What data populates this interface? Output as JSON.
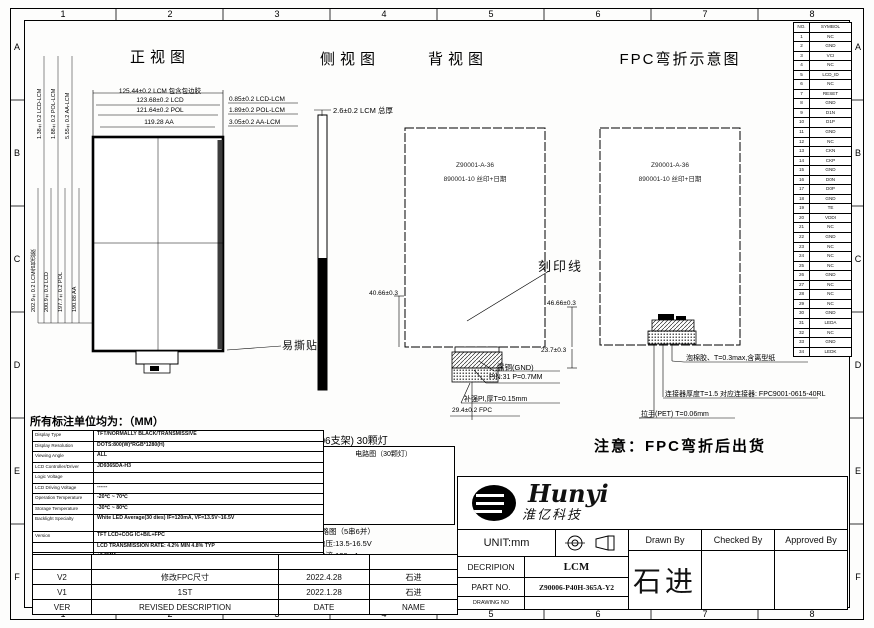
{
  "sheet": {
    "columns": [
      "1",
      "2",
      "3",
      "4",
      "5",
      "6",
      "7",
      "8"
    ],
    "rows": [
      "A",
      "B",
      "C",
      "D",
      "E",
      "F"
    ]
  },
  "views": {
    "front": {
      "title": "正视图",
      "h_dims": [
        "125.44±0.2 LCM 包含包边胶",
        "123.68±0.2 LCD",
        "121.64±0.2 POL",
        "119.28 AA"
      ],
      "h_side_dims": [
        "0.85±0.2 LCD-LCM",
        "1.89±0.2 POL-LCM",
        "3.05±0.2 AA-LCM"
      ],
      "v_dims_top": [
        "1.38±0.2 LCD-LCM",
        "1.88±0.2 POL-LCM",
        "5.55±0.2 AA-LCM"
      ],
      "v_dims": [
        "202.9±0.2 LCM含包边胶",
        "200.9±0.2 LCD",
        "197.7±0.2 POL",
        "190.88 AA"
      ],
      "tear_label": "易撕贴"
    },
    "side": {
      "title": "侧视图",
      "thickness_dim": "2.6±0.2 LCM 总厚"
    },
    "back": {
      "title": "背视图",
      "center_line1": "Z90001-A-36",
      "center_line2": "890001-10 丝印+日期",
      "engrave_callout": "刻印线",
      "dim_left": "40.66±0.3",
      "dim_right": "46.66±0.3",
      "dim_right2": "23.7±0.3",
      "label_gnd": "露铜(GND)",
      "label_pin": "PIN:31 P=0.7MM",
      "label_stiffener": "补强PI,厚T=0.15mm",
      "label_fpc_width": "29.4±0.2 FPC"
    },
    "fpc": {
      "title": "FPC弯折示意图",
      "center_line1": "Z90001-A-36",
      "center_line2": "890001-10 丝印+日期",
      "callout_foam": "泡棉胶、T=0.3max,含离型纸",
      "callout_connector": "连接器厚度T=1.5 对应连接器: FPC9001-0615-40RL",
      "callout_handle": "拉手(PET) T=0.06mm"
    }
  },
  "notes": {
    "units": "所有标注单位均为：（MM）",
    "ship": "注意：FPC弯折后出货"
  },
  "circuit": {
    "heading": "(3006支架) 30颗灯",
    "box_label": "电路图（30颗灯）",
    "sub1": "电路图（5串6并）",
    "sub2": "电压:13.5-16.5V",
    "sub3": "电流:120mA"
  },
  "spec_table": {
    "rows": [
      {
        "label": "Display Type",
        "value": "TFT/NORMALLY BLACK/TRANSMISSIVE"
      },
      {
        "label": "Display Resolution",
        "value": "DOTS:800(W)*RGB*1280(H)"
      },
      {
        "label": "Viewing Angle",
        "value": "ALL"
      },
      {
        "label": "LCD Controller/Driver",
        "value": "JD9365DA-H3"
      },
      {
        "label": "Logic Voltage",
        "value": ""
      },
      {
        "label": "LCD Driving Voltage",
        "value": "------"
      },
      {
        "label": "Operation Temperature",
        "value": "-20℃ ~ 70℃"
      },
      {
        "label": "Storage Temperature",
        "value": "-30℃ ~ 80℃"
      },
      {
        "label": "Backlight Specialty",
        "value": "White LED Average(30 dies) IF=120mA, VF=13.5V~16.5V"
      },
      {
        "label": "Version",
        "value": "TFT LCD+COG IC+B/L+FPC"
      },
      {
        "label": "",
        "value": "LCD TRANSMISSION RATE: 4.2% MIN 4.8% TYP"
      },
      {
        "label": "Unmarked tolerances",
        "value": "±0.2MM"
      },
      {
        "label": "",
        "value": "*:Critical dimension"
      }
    ]
  },
  "revision_table": {
    "headers": {
      "ver": "VER",
      "desc": "REVISED DESCRIPTION",
      "date": "DATE",
      "name": "NAME"
    },
    "rows": [
      {
        "ver": "V2",
        "desc": "修改FPC尺寸",
        "date": "2022.4.28",
        "name": "石进"
      },
      {
        "ver": "V1",
        "desc": "1ST",
        "date": "2022.1.28",
        "name": "石进"
      }
    ]
  },
  "title_block": {
    "logo_text": "Hunyi",
    "logo_sub": "淮亿科技",
    "unit": "UNIT:mm",
    "desc_label": "DECRIPION",
    "desc_value": "LCM",
    "part_label": "PART NO.",
    "part_value": "Z90006-P40H-365A-Y2",
    "drawing_label": "DRAWING NO",
    "drawn_by": "Drawn By",
    "checked_by": "Checked By",
    "approved_by": "Approved By",
    "drawn_name": "石进",
    "checked_name": "",
    "approved_name": ""
  },
  "pin_table": {
    "headers": {
      "no": "NO.",
      "sym": "SYMBOL"
    },
    "rows": [
      {
        "no": "1",
        "sym": "NC"
      },
      {
        "no": "2",
        "sym": "GND"
      },
      {
        "no": "3",
        "sym": "VCI"
      },
      {
        "no": "4",
        "sym": "NC"
      },
      {
        "no": "5",
        "sym": "LCD_ID"
      },
      {
        "no": "6",
        "sym": "NC"
      },
      {
        "no": "7",
        "sym": "RESET"
      },
      {
        "no": "8",
        "sym": "GND"
      },
      {
        "no": "9",
        "sym": "D1N"
      },
      {
        "no": "10",
        "sym": "D1P"
      },
      {
        "no": "11",
        "sym": "GND"
      },
      {
        "no": "12",
        "sym": "NC"
      },
      {
        "no": "13",
        "sym": "CKN"
      },
      {
        "no": "14",
        "sym": "CKP"
      },
      {
        "no": "15",
        "sym": "GND"
      },
      {
        "no": "16",
        "sym": "D0N"
      },
      {
        "no": "17",
        "sym": "D0P"
      },
      {
        "no": "18",
        "sym": "GND"
      },
      {
        "no": "19",
        "sym": "TE"
      },
      {
        "no": "20",
        "sym": "VDDI"
      },
      {
        "no": "21",
        "sym": "NC"
      },
      {
        "no": "22",
        "sym": "GND"
      },
      {
        "no": "23",
        "sym": "NC"
      },
      {
        "no": "24",
        "sym": "NC"
      },
      {
        "no": "25",
        "sym": "NC"
      },
      {
        "no": "26",
        "sym": "GND"
      },
      {
        "no": "27",
        "sym": "NC"
      },
      {
        "no": "28",
        "sym": "NC"
      },
      {
        "no": "29",
        "sym": "NC"
      },
      {
        "no": "30",
        "sym": "GND"
      },
      {
        "no": "31",
        "sym": "LEDA"
      },
      {
        "no": "32",
        "sym": "NC"
      },
      {
        "no": "33",
        "sym": "GND"
      },
      {
        "no": "34",
        "sym": "LEDK"
      }
    ]
  }
}
